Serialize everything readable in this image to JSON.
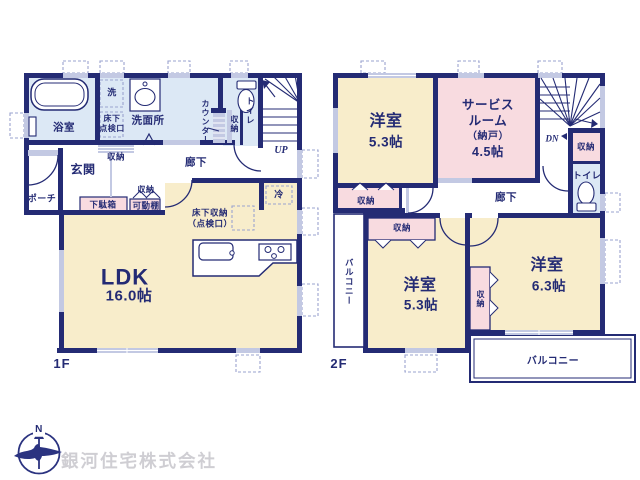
{
  "floor1": {
    "label": "1F",
    "rooms": {
      "bath": "浴室",
      "washer": "洗",
      "washroom": "洗面所",
      "floor_hatch": "床下\n点検口",
      "counter": "カウンター",
      "counter_storage": "収納",
      "toilet": "トイレ",
      "stairs": "UP",
      "hall_storage": "収納",
      "entrance": "玄関",
      "corridor": "廊下",
      "porch": "ポーチ",
      "shoe_cabinet": "下駄箱",
      "movable_shelf": "可動棚",
      "shelf_storage": "収納",
      "fridge": "冷",
      "underfloor_storage": "床下収納\n（点検口）",
      "ldk": "LDK",
      "ldk_size": "16.0帖"
    }
  },
  "floor2": {
    "label": "2F",
    "rooms": {
      "bedroom1": "洋室",
      "bedroom1_size": "5.3帖",
      "service_line1": "サービス",
      "service_line2": "ルーム",
      "service_line3": "（納戸）",
      "service_line4": "4.5帖",
      "stairs": "DN",
      "hall_storage": "収納",
      "toilet": "トイレ",
      "corridor": "廊下",
      "closet1": "収納",
      "closet2": "収納",
      "closet3": "収納",
      "balcony_side": "バルコニー",
      "bedroom2": "洋室",
      "bedroom2_size": "5.3帖",
      "bedroom3": "洋室",
      "bedroom3_size": "6.3帖",
      "balcony_bottom": "バルコニー"
    }
  },
  "footer": {
    "company": "銀河住宅株式会社",
    "compass_north": "N"
  },
  "colors": {
    "wall": "#242b74",
    "room_cream": "#f8edcb",
    "room_blue": "#dce8f5",
    "room_pink": "#f8dbe0",
    "fixture_gray": "#c3c9e3",
    "dashed_line": "#9aa3cf",
    "company_text": "#cfced3"
  }
}
